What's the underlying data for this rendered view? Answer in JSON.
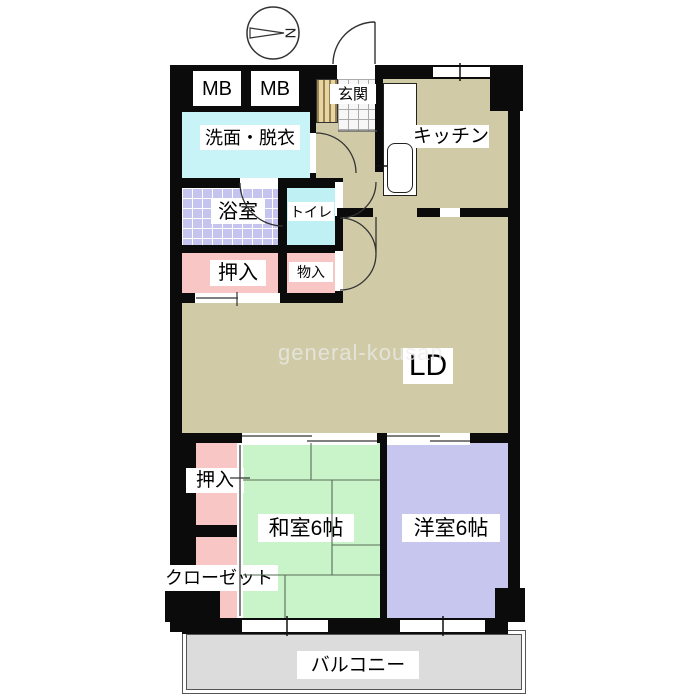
{
  "title": "apartment floor plan",
  "compass": {
    "label": "N"
  },
  "meter_boxes": [
    "MB",
    "MB"
  ],
  "rooms": {
    "genkan": "玄関",
    "kitchen": "キッチン",
    "washroom": "洗面・脱衣",
    "bathroom": "浴室",
    "toilet": "トイレ",
    "oshiire_upper": "押入",
    "monoire": "物入",
    "living_dining": "LD",
    "oshiire_lower": "押入",
    "closet": "クローゼット",
    "japanese_room": "和室6帖",
    "western_room": "洋室6帖",
    "balcony": "バルコニー"
  },
  "watermark": "general-kousan",
  "colors": {
    "floor_tan": "#d0cba6",
    "wall": "#0b0b0b",
    "washroom_cyan": "#c8f3f7",
    "toilet_cyan": "#bef0f4",
    "bath_lavender": "#c4c4ee",
    "closet_pink": "#f9c6c6",
    "tatami_green": "#c9f4c9",
    "western_purple": "#c6c6ef",
    "balcony_gray": "#dcdcdc",
    "tile_white": "#f7f7f7"
  }
}
